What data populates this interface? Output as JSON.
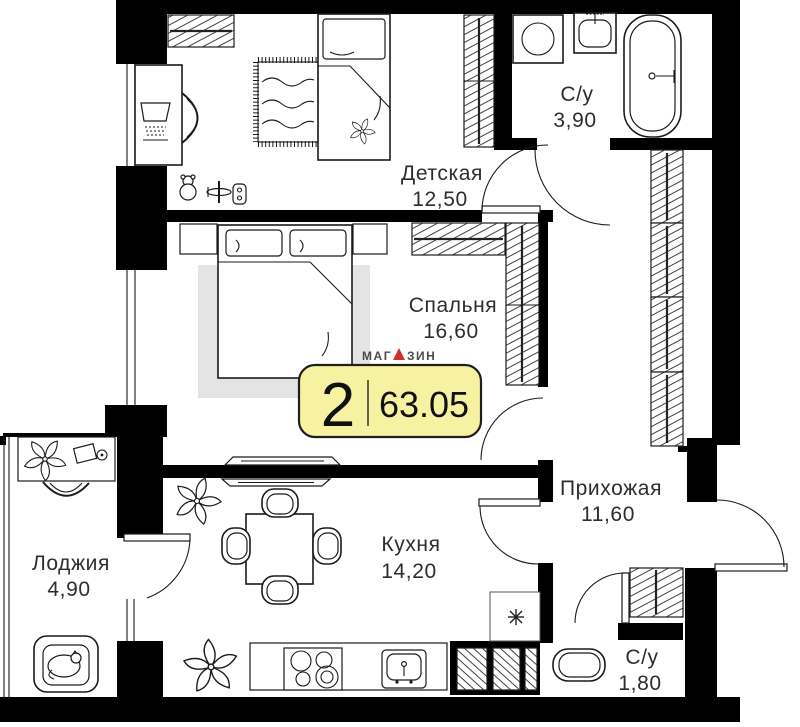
{
  "plan": {
    "type": "apartment-floor-plan",
    "rooms": [
      {
        "id": "detskaya",
        "name": "Детская",
        "area": "12,50"
      },
      {
        "id": "sanuzel-1",
        "name": "С/у",
        "area": "3,90"
      },
      {
        "id": "spalnya",
        "name": "Спальня",
        "area": "16,60"
      },
      {
        "id": "prihozhaya",
        "name": "Прихожая",
        "area": "11,60"
      },
      {
        "id": "lodzhiya",
        "name": "Лоджия",
        "area": "4,90"
      },
      {
        "id": "kuhnya",
        "name": "Кухня",
        "area": "14,20"
      },
      {
        "id": "sanuzel-2",
        "name": "С/у",
        "area": "1,80"
      }
    ],
    "badge": {
      "rooms_count": "2",
      "total_area": "63.05",
      "bg": "#f6f2a2",
      "border": "#1f1f1f"
    },
    "logo": {
      "brand_part1": "МАГ",
      "brand_part2": "ЗИН",
      "brand_line2": "КВАРТИР",
      "tagline": "агентство недвижимости",
      "accent": "#cf2f28",
      "text_color": "#4b4b4b"
    },
    "colors": {
      "wall": "#000000",
      "line": "#1a1a1a",
      "rug": "#e4e4e4",
      "background": "#ffffff"
    }
  }
}
